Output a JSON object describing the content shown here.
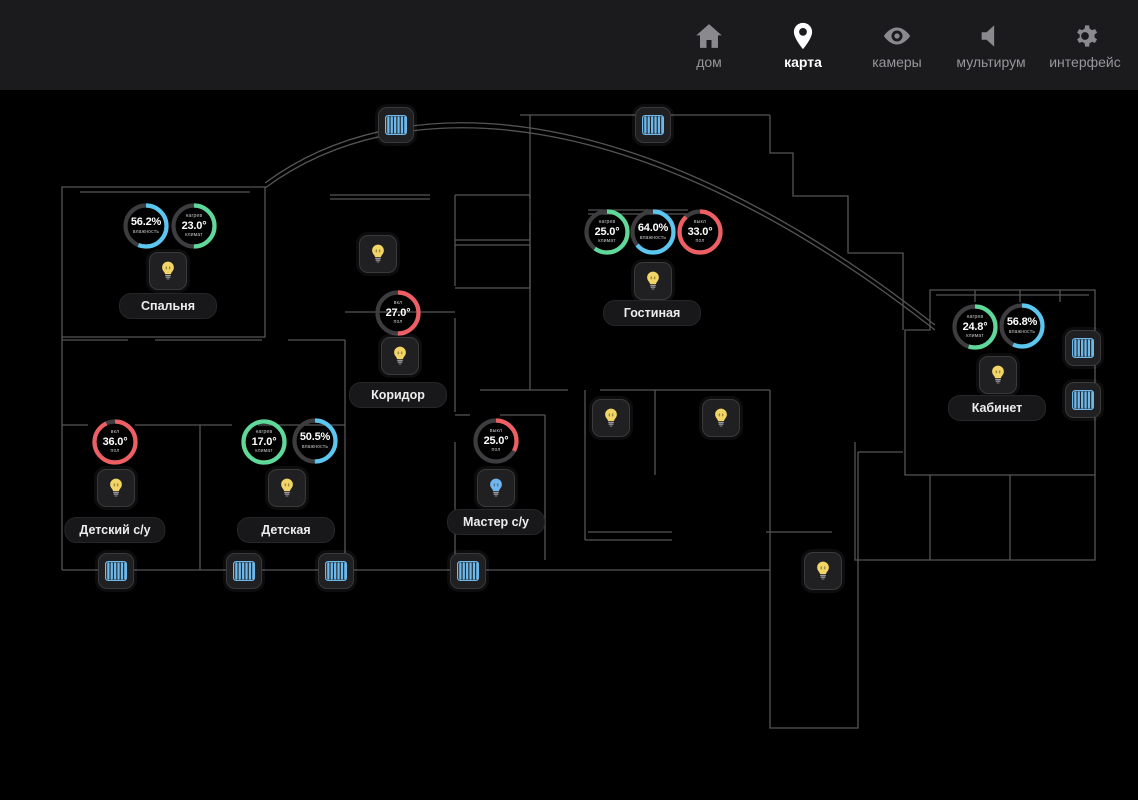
{
  "nav": {
    "items": [
      {
        "id": "home",
        "label": "дом",
        "icon": "home-icon",
        "active": false
      },
      {
        "id": "map",
        "label": "карта",
        "icon": "map-pin-icon",
        "active": true
      },
      {
        "id": "cameras",
        "label": "камеры",
        "icon": "camera-eye-icon",
        "active": false
      },
      {
        "id": "multiroom",
        "label": "мультирум",
        "icon": "speaker-icon",
        "active": false
      },
      {
        "id": "interface",
        "label": "интерфейс",
        "icon": "gear-icon",
        "active": false
      }
    ]
  },
  "colors": {
    "topbar_bg": "#1b1b1d",
    "nav_inactive": "#8a8a8e",
    "nav_active": "#ffffff",
    "ring_base": "#3d3d40",
    "green": "#5fd99a",
    "cyan": "#5bc6f0",
    "red": "#ee5f64",
    "bulb_yellow": "#f2d566",
    "bulb_blue": "#6fb6f0",
    "blinds_blue": "#6cb8ea",
    "wall": "#555555"
  },
  "map": {
    "gauges": [
      {
        "room": "Спальня",
        "kind": "humidity",
        "value": "56.2%",
        "top_label": "",
        "bottom_label": "влажность",
        "fraction": 0.56,
        "color": "cyan",
        "x": 146,
        "y": 226
      },
      {
        "room": "Спальня",
        "kind": "climate",
        "value": "23.0°",
        "top_label": "нагрев",
        "bottom_label": "климат",
        "fraction": 0.5,
        "color": "green",
        "x": 194,
        "y": 226
      },
      {
        "room": "Гостиная",
        "kind": "climate",
        "value": "25.0°",
        "top_label": "нагрев",
        "bottom_label": "климат",
        "fraction": 0.6,
        "color": "green",
        "x": 607,
        "y": 232
      },
      {
        "room": "Гостиная",
        "kind": "humidity",
        "value": "64.0%",
        "top_label": "",
        "bottom_label": "влажность",
        "fraction": 0.64,
        "color": "cyan",
        "x": 653,
        "y": 232
      },
      {
        "room": "Гостиная",
        "kind": "floor",
        "value": "33.0°",
        "top_label": "выкл",
        "bottom_label": "пол",
        "fraction": 0.88,
        "color": "red",
        "x": 700,
        "y": 232
      },
      {
        "room": "Коридор",
        "kind": "floor",
        "value": "27.0°",
        "top_label": "вкл",
        "bottom_label": "пол",
        "fraction": 0.5,
        "color": "red",
        "x": 398,
        "y": 313
      },
      {
        "room": "Кабинет",
        "kind": "climate",
        "value": "24.8°",
        "top_label": "нагрев",
        "bottom_label": "климат",
        "fraction": 0.55,
        "color": "green",
        "x": 975,
        "y": 327
      },
      {
        "room": "Кабинет",
        "kind": "humidity",
        "value": "56.8%",
        "top_label": "",
        "bottom_label": "влажность",
        "fraction": 0.57,
        "color": "cyan",
        "x": 1022,
        "y": 326
      },
      {
        "room": "Детский с/у",
        "kind": "floor",
        "value": "36.0°",
        "top_label": "вкл",
        "bottom_label": "пол",
        "fraction": 0.93,
        "color": "red",
        "x": 115,
        "y": 442
      },
      {
        "room": "Детская",
        "kind": "climate",
        "value": "17.0°",
        "top_label": "нагрев",
        "bottom_label": "климат",
        "fraction": 1.0,
        "color": "green",
        "x": 264,
        "y": 442
      },
      {
        "room": "Детская",
        "kind": "humidity",
        "value": "50.5%",
        "top_label": "",
        "bottom_label": "влажность",
        "fraction": 0.5,
        "color": "cyan",
        "x": 315,
        "y": 441
      },
      {
        "room": "Мастер с/у",
        "kind": "floor",
        "value": "25.0°",
        "top_label": "выкл",
        "bottom_label": "пол",
        "fraction": 0.33,
        "color": "red",
        "x": 496,
        "y": 441
      }
    ],
    "lights": [
      {
        "id": "light-1",
        "x": 167,
        "y": 270,
        "state": "yellow"
      },
      {
        "id": "light-2",
        "x": 377,
        "y": 253,
        "state": "yellow"
      },
      {
        "id": "light-3",
        "x": 399,
        "y": 355,
        "state": "yellow"
      },
      {
        "id": "light-4",
        "x": 652,
        "y": 280,
        "state": "yellow"
      },
      {
        "id": "light-5",
        "x": 610,
        "y": 417,
        "state": "yellow"
      },
      {
        "id": "light-6",
        "x": 720,
        "y": 417,
        "state": "yellow"
      },
      {
        "id": "light-7",
        "x": 997,
        "y": 374,
        "state": "yellow"
      },
      {
        "id": "light-8",
        "x": 115,
        "y": 487,
        "state": "yellow"
      },
      {
        "id": "light-9",
        "x": 286,
        "y": 487,
        "state": "yellow"
      },
      {
        "id": "light-10",
        "x": 495,
        "y": 487,
        "state": "blue"
      },
      {
        "id": "light-11",
        "x": 822,
        "y": 570,
        "state": "yellow"
      }
    ],
    "blinds": [
      {
        "id": "blinds-1",
        "x": 395,
        "y": 124
      },
      {
        "id": "blinds-2",
        "x": 652,
        "y": 124
      },
      {
        "id": "blinds-3",
        "x": 1082,
        "y": 347
      },
      {
        "id": "blinds-4",
        "x": 1082,
        "y": 399
      },
      {
        "id": "blinds-5",
        "x": 115,
        "y": 570
      },
      {
        "id": "blinds-6",
        "x": 243,
        "y": 570
      },
      {
        "id": "blinds-7",
        "x": 335,
        "y": 570
      },
      {
        "id": "blinds-8",
        "x": 467,
        "y": 570
      }
    ],
    "labels": [
      {
        "text": "Спальня",
        "x": 168,
        "y": 306
      },
      {
        "text": "Гостиная",
        "x": 652,
        "y": 313
      },
      {
        "text": "Коридор",
        "x": 398,
        "y": 395
      },
      {
        "text": "Кабинет",
        "x": 997,
        "y": 408
      },
      {
        "text": "Детский с/у",
        "x": 115,
        "y": 530
      },
      {
        "text": "Детская",
        "x": 286,
        "y": 530
      },
      {
        "text": "Мастер с/у",
        "x": 496,
        "y": 522
      }
    ]
  }
}
